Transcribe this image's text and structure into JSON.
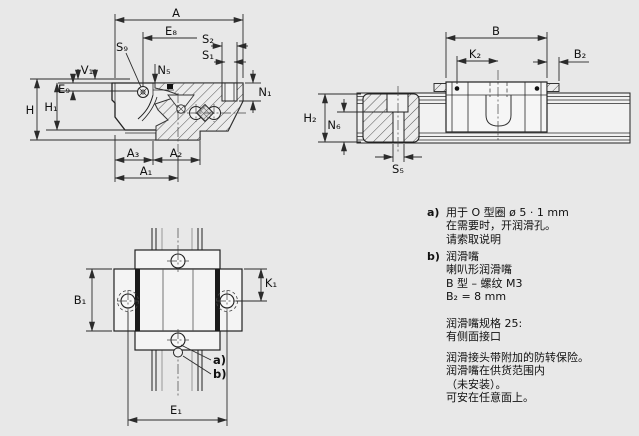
{
  "colors": {
    "background": "#e8e8e8",
    "line": "#2b2b2b",
    "hatch_fill": "#ececec"
  },
  "views": {
    "cross_section": {
      "labels": {
        "A": "A",
        "E8": "E₈",
        "S9": "S₉",
        "S2": "S₂",
        "S1": "S₁",
        "N5": "N₅",
        "V1": "V₁",
        "E9": "E₉",
        "H": "H",
        "H1": "H₁",
        "N1": "N₁",
        "A3": "A₃",
        "A2": "A₂",
        "A1": "A₁"
      }
    },
    "side_view": {
      "labels": {
        "B": "B",
        "K2": "K₂",
        "B2": "B₂",
        "H2": "H₂",
        "N6": "N₆",
        "S5": "S₅"
      }
    },
    "top_view": {
      "labels": {
        "B1": "B₁",
        "K1": "K₁",
        "E1": "E₁",
        "ref_a": "a)",
        "ref_b": "b)"
      }
    }
  },
  "notes": {
    "a": {
      "marker": "a)",
      "lines": [
        "用于 O 型圈 ø 5 · 1 mm",
        "在需要时，开润滑孔。",
        "请索取说明"
      ]
    },
    "b": {
      "marker": "b)",
      "lines": [
        "润滑嘴",
        "喇叭形润滑嘴",
        "B 型 – 螺纹 M3",
        "B₂ = 8 mm"
      ]
    },
    "spec": {
      "lines": [
        "润滑嘴规格 25:",
        "有侧面接口"
      ]
    },
    "info": {
      "lines": [
        "润滑接头带附加的防转保险。",
        "润滑嘴在供货范围内",
        "（未安装）。",
        "可安在任意面上。"
      ]
    }
  }
}
